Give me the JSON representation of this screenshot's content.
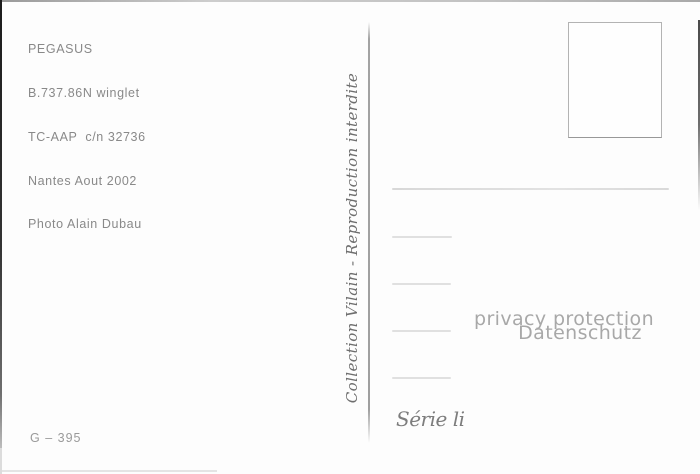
{
  "postcard": {
    "info_lines": [
      "PEGASUS",
      "B.737.86N winglet",
      "TC-AAP  c/n 32736",
      "Nantes Aout 2002",
      "Photo Alain Dubau"
    ],
    "vertical_text": "Collection Vilain - Reproduction interdite",
    "series_label": "Série li",
    "catalog_number": "G – 395"
  },
  "watermark": {
    "line1": "privacy protection",
    "line2": "Datenschutz"
  },
  "colors": {
    "info_text": "#898989",
    "collection_text": "#6e6e6e",
    "watermark_text": "#a8a8a8",
    "divider": "#a0a0a0",
    "stamp_border": "#b3b3b3",
    "address_line": "#e0e0e0",
    "background": "#fdfdfd"
  }
}
